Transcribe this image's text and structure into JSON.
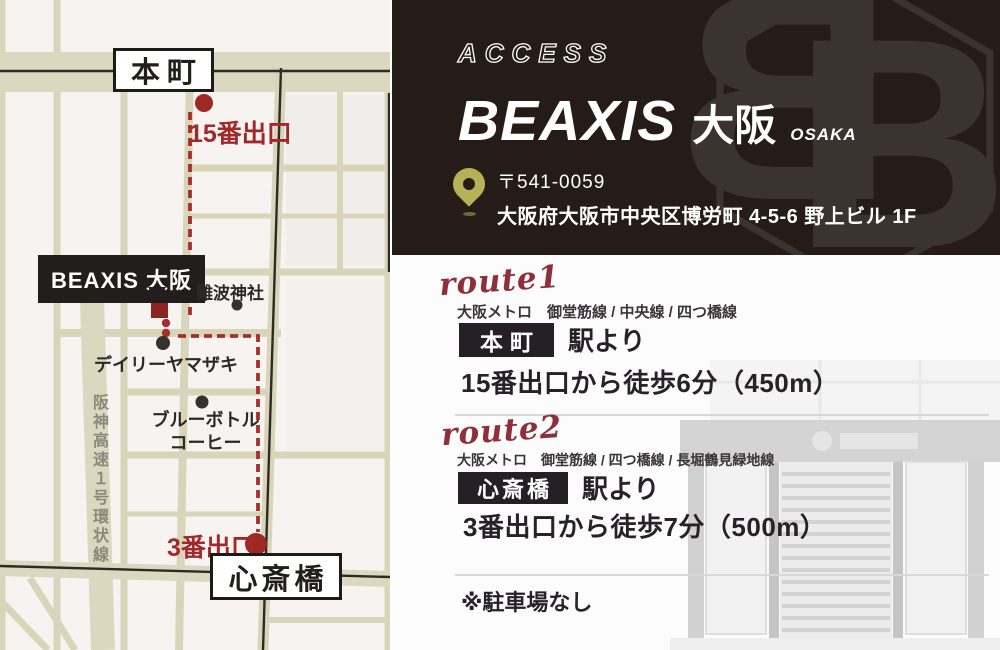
{
  "map": {
    "station_top": "本町",
    "station_bottom": "心斎橋",
    "exit_top": "15番出口",
    "exit_bottom": "3番出口",
    "business": "BEAXIS 大阪",
    "poi_shrine": "難波神社",
    "poi_convenience": "デイリーヤマザキ",
    "poi_coffee": "ブルーボトル\nコーヒー",
    "highway": "阪神高速１号環状線"
  },
  "header": {
    "kicker": "ACCESS",
    "brand": "BEAXIS",
    "brand_jp": "大阪",
    "brand_sub": "OSAKA",
    "postal": "〒541-0059",
    "address": "大阪府大阪市中央区博労町 4-5-6 野上ビル 1F"
  },
  "routes": [
    {
      "script": "route1",
      "lines": "大阪メトロ　御堂筋線 / 中央線 / 四つ橋線",
      "station": "本町",
      "from_station": "駅より",
      "walk": "15番出口から徒歩6分（450m）"
    },
    {
      "script": "route2",
      "lines": "大阪メトロ　御堂筋線 / 四つ橋線 / 長堀鶴見緑地線",
      "station": "心斎橋",
      "from_station": "駅より",
      "walk": "3番出口から徒歩7分（500m）"
    }
  ],
  "note": "※駐車場なし",
  "colors": {
    "header_bg": "#251c18",
    "accent_red": "#a5302b",
    "marker_red": "#8c2420",
    "script_maroon": "#8e2f3a",
    "pin_olive": "#b5b158",
    "map_street": "#d9d5ba",
    "map_bg": "#f7f3f0",
    "badge_bg": "#242023"
  }
}
